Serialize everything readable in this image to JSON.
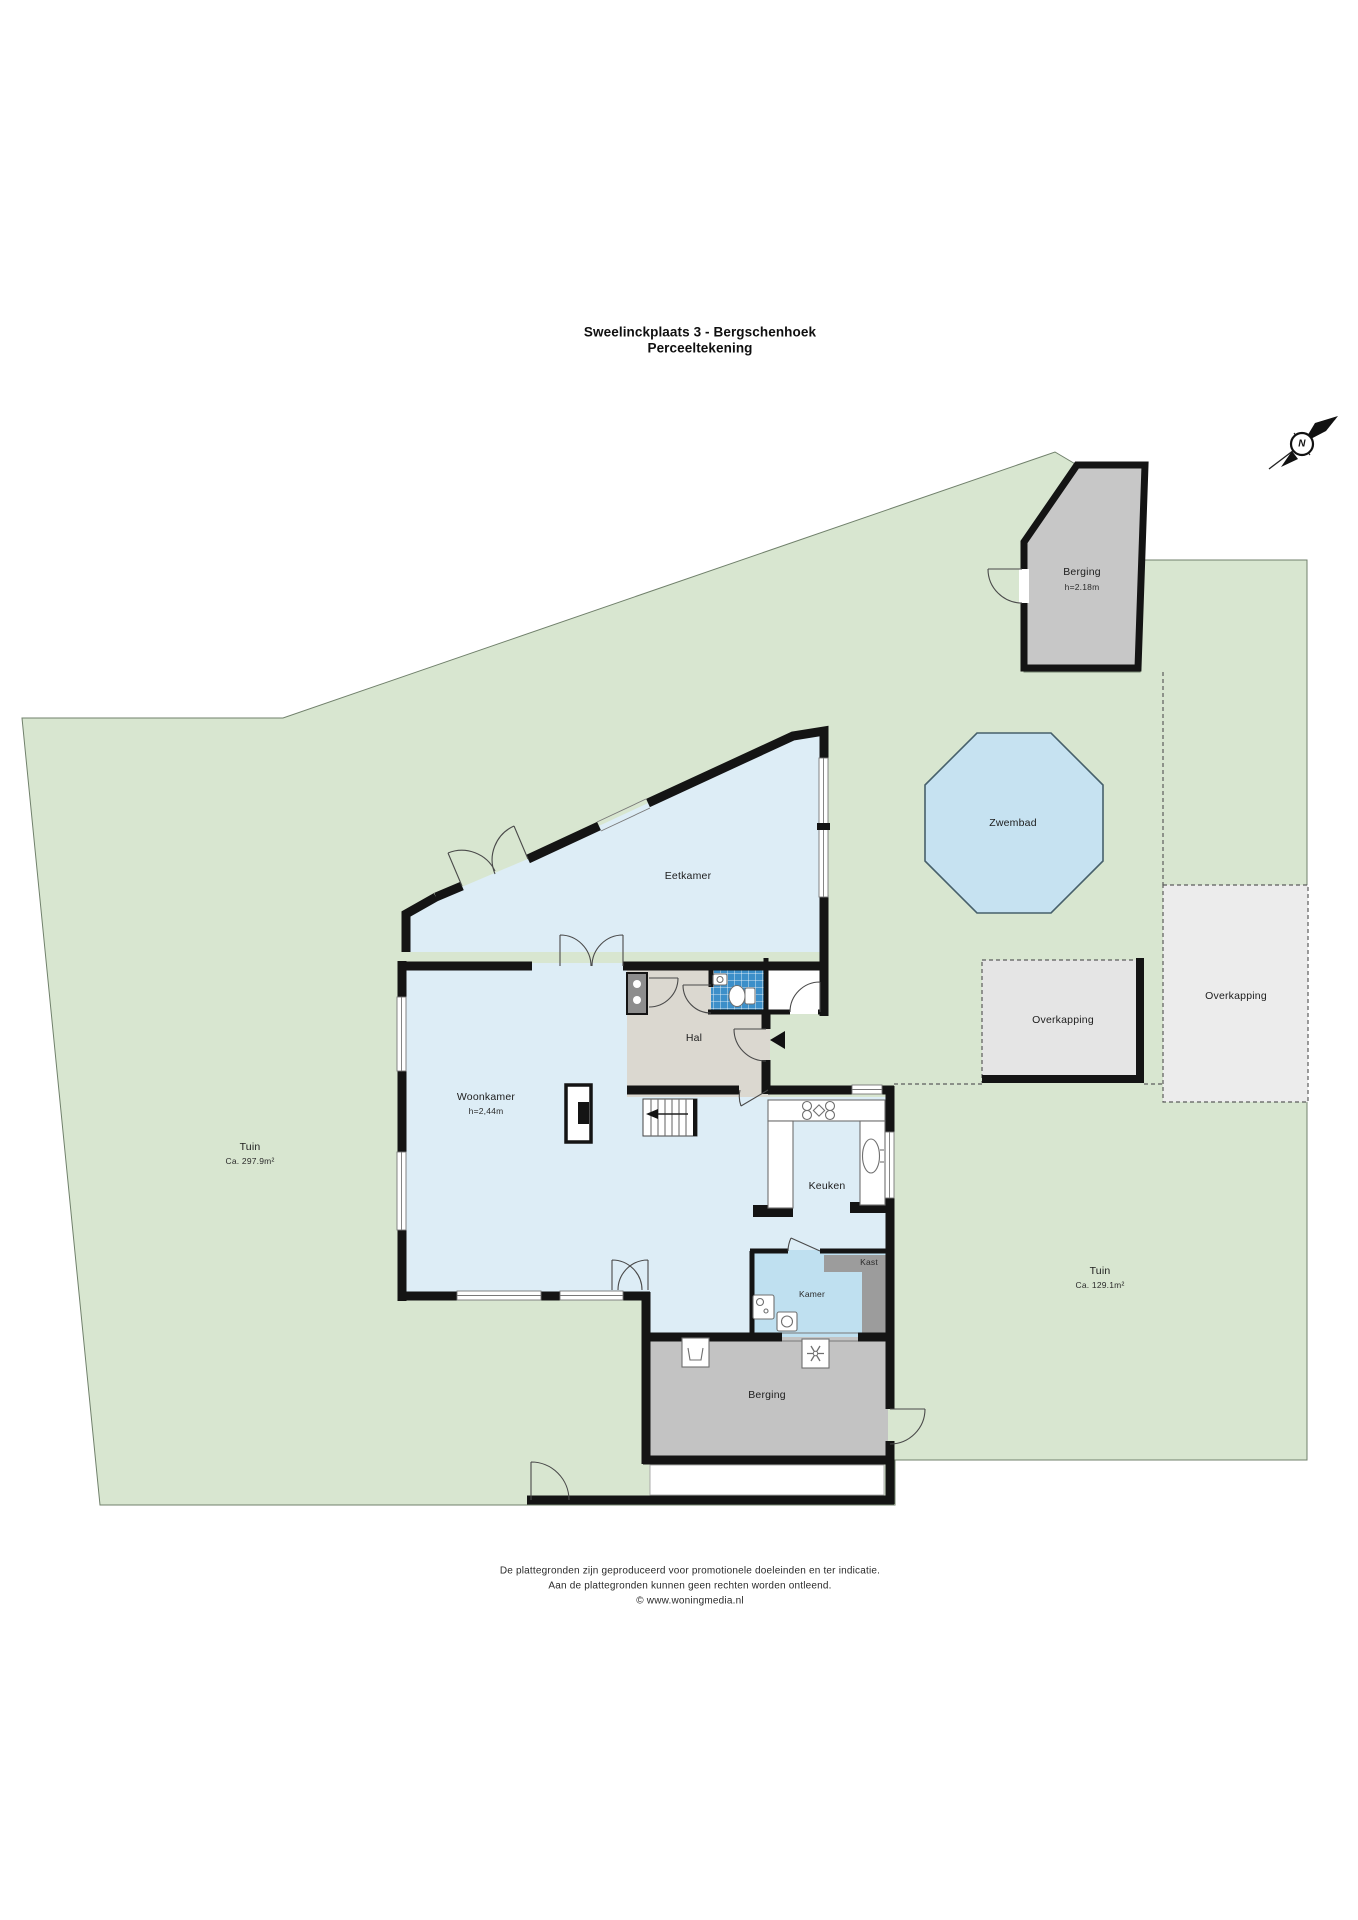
{
  "title": {
    "line1": "Sweelinckplaats 3 - Bergschenhoek",
    "line2": "Perceeltekening"
  },
  "compass": {
    "north": "N"
  },
  "plan": {
    "garden_left": {
      "label": "Tuin",
      "area": "Ca. 297.9m²"
    },
    "garden_right": {
      "label": "Tuin",
      "area": "Ca. 129.1m²"
    },
    "shed_top": {
      "label": "Berging",
      "height": "h=2.18m"
    },
    "pool_label": "Zwembad",
    "canopy_left_label": "Overkapping",
    "canopy_right_label": "Overkapping",
    "rooms": {
      "eetkamer": "Eetkamer",
      "woonkamer": "Woonkamer",
      "woonkamer_height": "h=2,44m",
      "hal": "Hal",
      "keuken": "Keuken",
      "kamer": "Kamer",
      "kast": "Kast",
      "berging": "Berging"
    }
  },
  "footer": {
    "line1": "De plattegronden zijn geproduceerd voor promotionele doeleinden en ter indicatie.",
    "line2": "Aan de plattegronden kunnen geen rechten worden ontleend.",
    "line3": "© www.woningmedia.nl"
  },
  "colors": {
    "garden": "#d8e6d0",
    "gardenStroke": "#70806b",
    "roomBlue": "#ddedf6",
    "kamerBlue": "#bfe0f0",
    "halGray": "#dbd8d0",
    "tile": "#3c8fc9",
    "shedGray": "#c7c7c7",
    "bergGray": "#c3c3c3",
    "kastGray": "#9c9c9c",
    "canopy": "#ececec",
    "canopyL": "#e5e5e5",
    "pool": "#c6e2f1",
    "wall": "#141414"
  }
}
